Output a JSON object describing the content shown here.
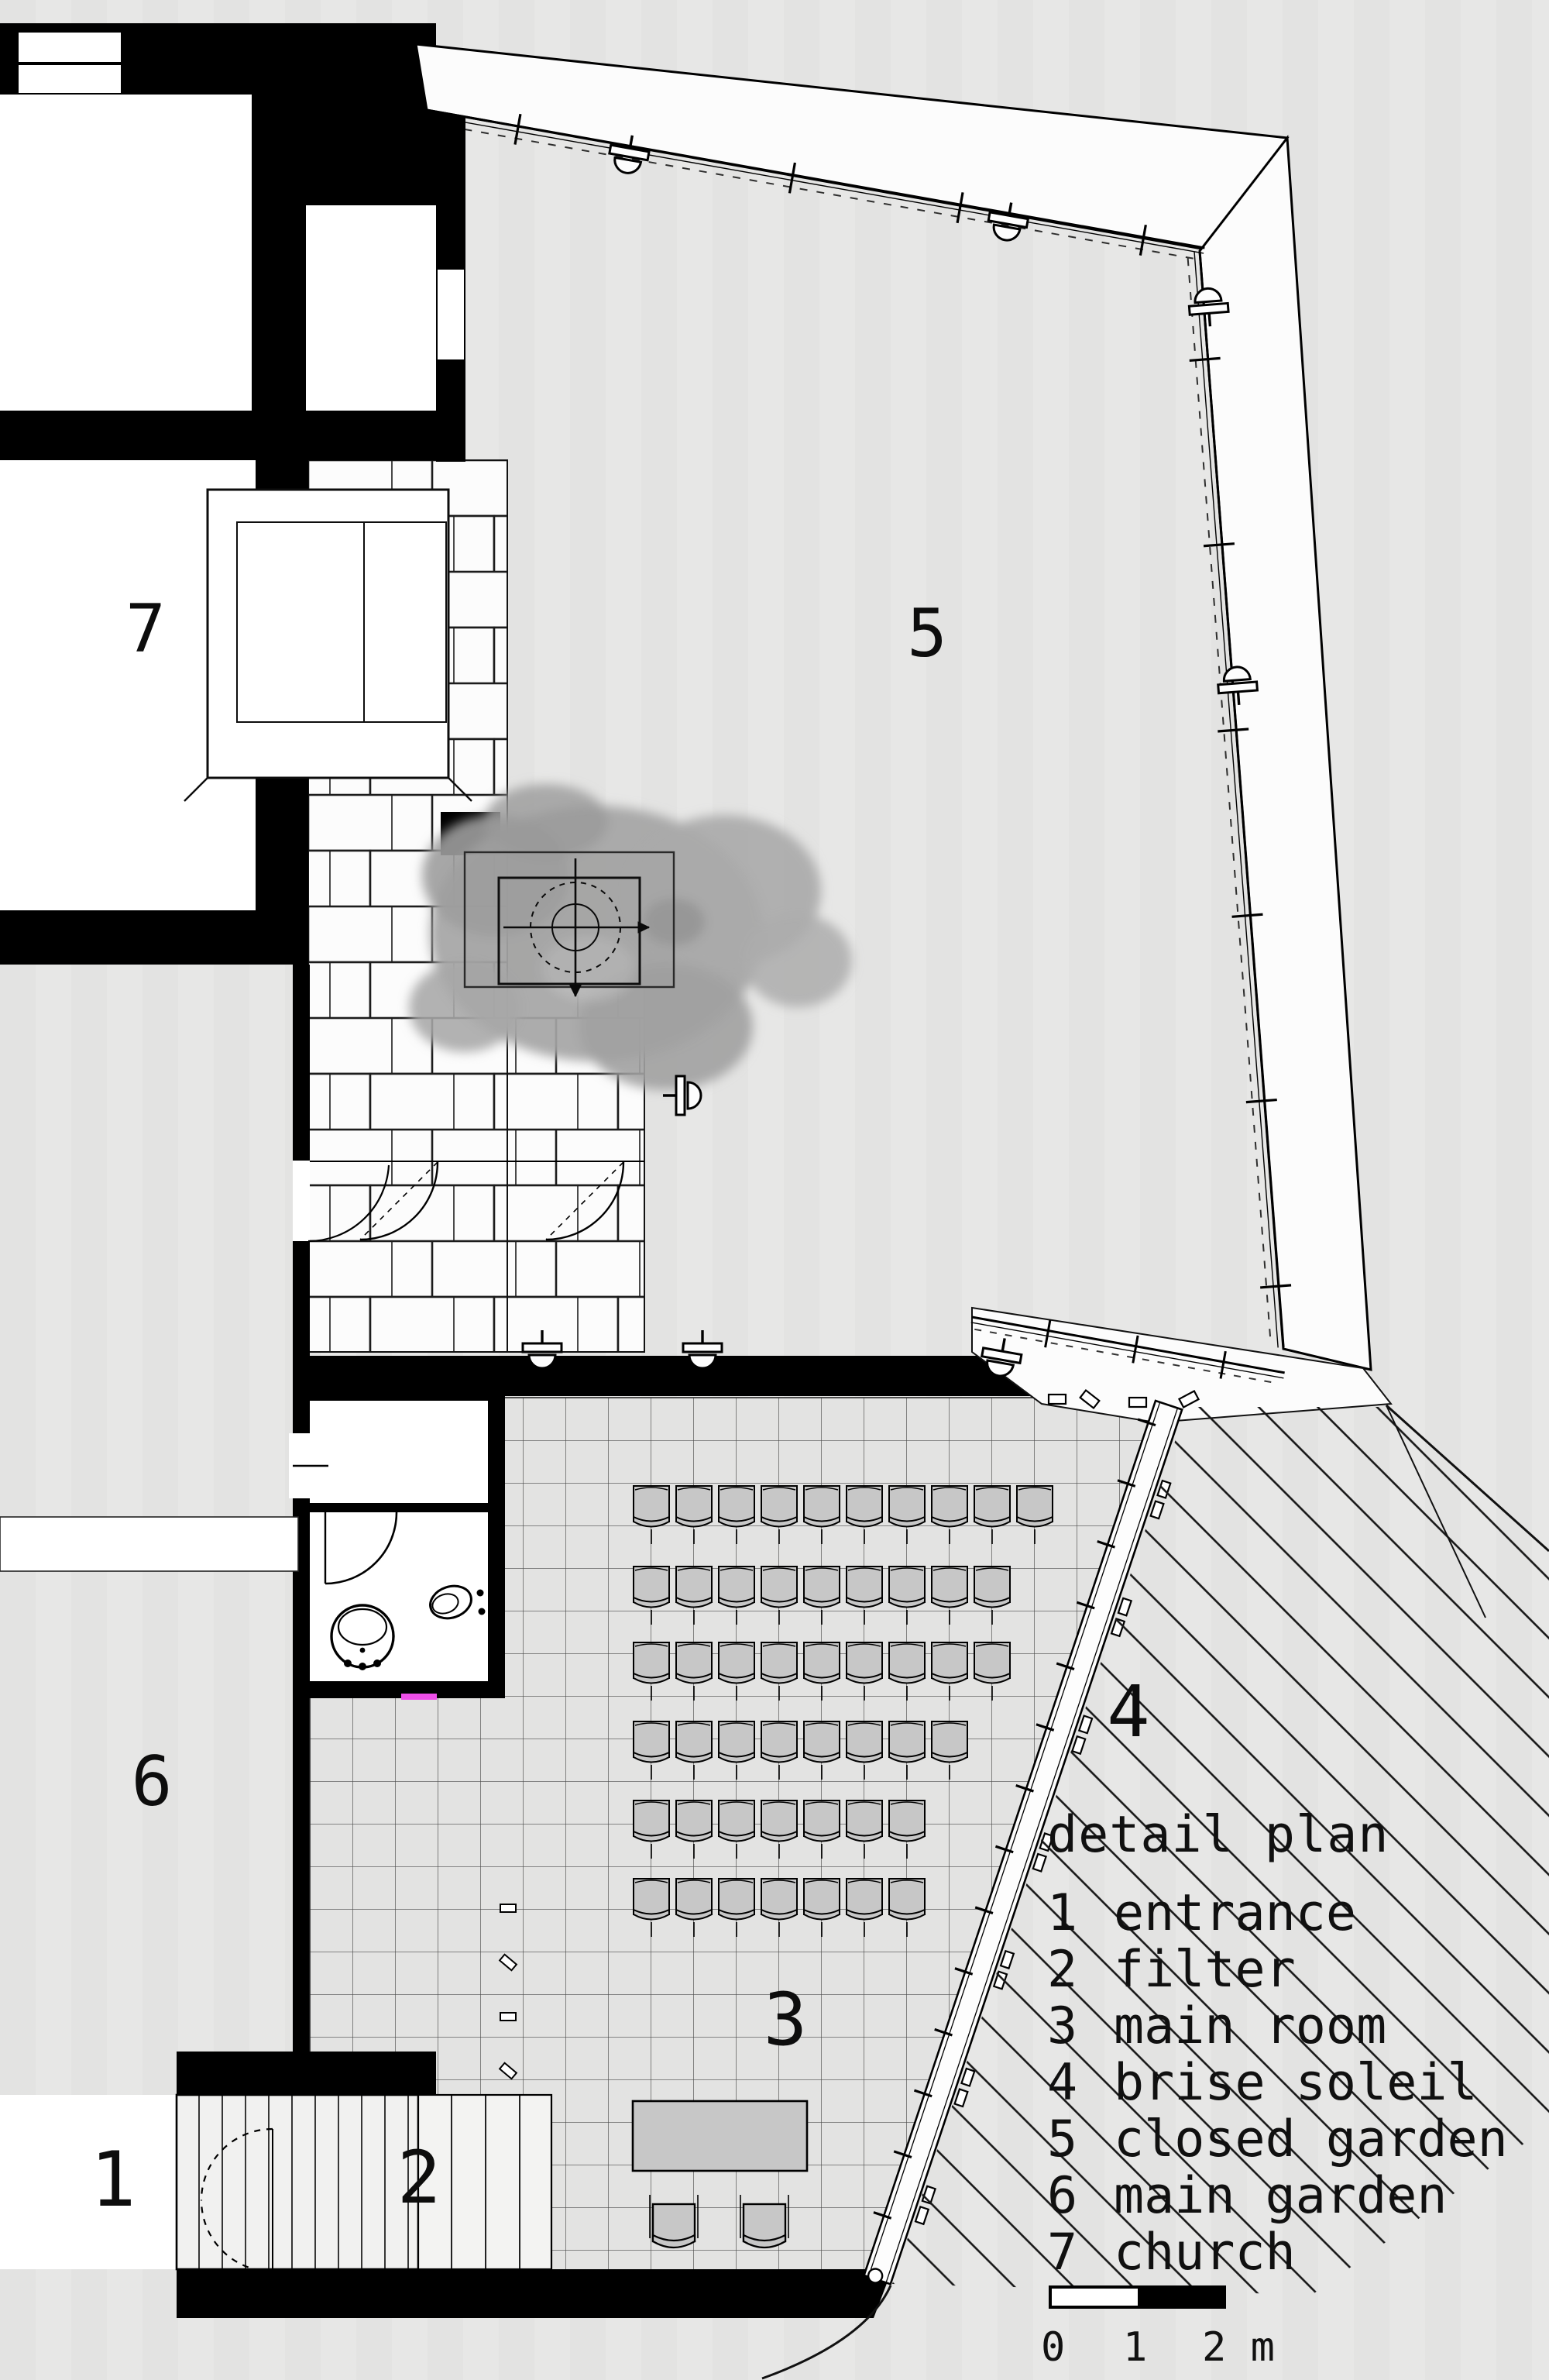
{
  "colors": {
    "background": "#e7e7e6",
    "ink": "#0c0c0c",
    "chair_fill": "#c7c7c7",
    "stone_white": "#fbfbfb",
    "accent_magenta": "#ee4fe8"
  },
  "legend": {
    "title": "detail plan",
    "items": [
      {
        "num": "1",
        "name": "entrance"
      },
      {
        "num": "2",
        "name": "filter"
      },
      {
        "num": "3",
        "name": "main room"
      },
      {
        "num": "4",
        "name": "brise soleil"
      },
      {
        "num": "5",
        "name": "closed garden"
      },
      {
        "num": "6",
        "name": "main garden"
      },
      {
        "num": "7",
        "name": "church"
      }
    ]
  },
  "scale_bar": {
    "labels": [
      "0",
      "1",
      "2 m"
    ]
  },
  "plan": {
    "chair_rows": [
      10,
      9,
      9,
      8,
      7,
      7
    ]
  }
}
